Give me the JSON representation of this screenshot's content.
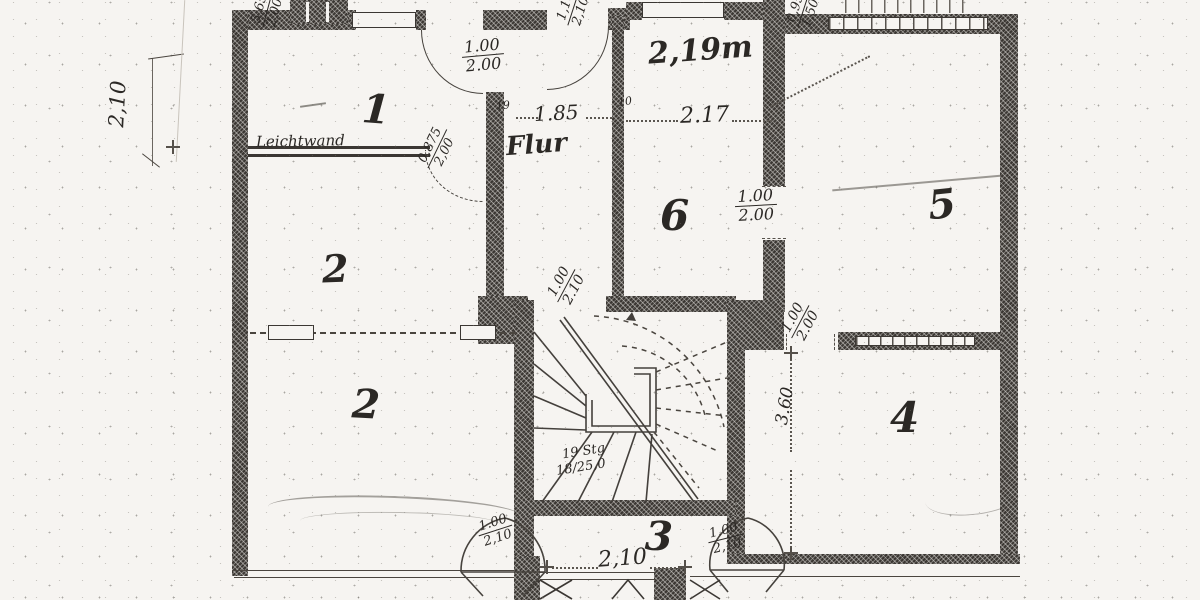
{
  "rooms": {
    "r1": "1",
    "r2a": "2",
    "r2b": "2",
    "r3": "3",
    "r4": "4",
    "r5": "5",
    "r6": "6"
  },
  "texts": {
    "flur": "Flur",
    "leichtwand": "Leichtwand",
    "height_note": "2,19m"
  },
  "dims": {
    "left_v": "2,10",
    "stack_tl_num": "5,65",
    "stack_tl_den": "2,00",
    "door_r1_num": "1.00",
    "door_r1_den": "2.00",
    "door_flur_num": "1,10",
    "door_flur_den": "2,10",
    "win_tr_num": "0,95",
    "win_tr_den": "1,50",
    "flur_w": "1.85",
    "r6_w": "2.17",
    "wt19": "19",
    "wt10": "10",
    "door_lw_num": "0,875",
    "door_lw_den": "2,00",
    "door65_num": "1.00",
    "door65_den": "2.00",
    "door_fs_num": "1.00",
    "door_fs_den": "2.10",
    "door_mr_num": "1.00",
    "door_mr_den": "2.00",
    "r4_w": "3.60",
    "corr_w": "2,10",
    "door_cl_num": "1.00",
    "door_cl_den": "2,10",
    "door_cr_num": "1.00",
    "door_cr_den": "2,10"
  },
  "stairs_note": {
    "line1": "19 Stg",
    "line2": "18/25,0"
  },
  "colors": {
    "paper": "#f6f4f1",
    "ink": "#2b2825",
    "wall": "#3b3733"
  }
}
